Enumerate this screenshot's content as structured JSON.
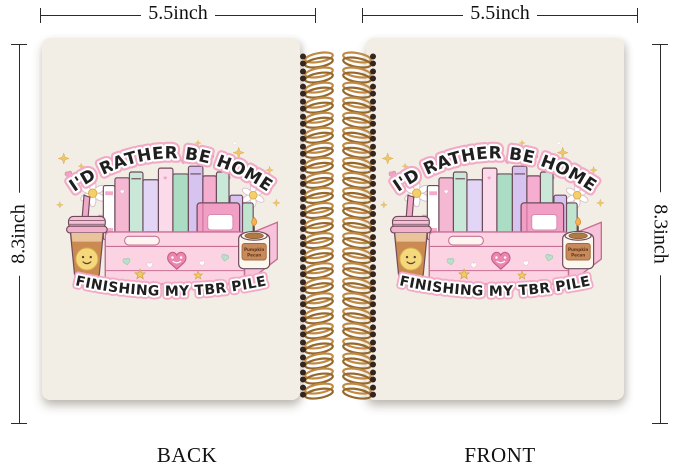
{
  "product_photo": {
    "background": "#ffffff",
    "dimensions": {
      "width_label": "5.5inch",
      "height_label": "8.3inch"
    },
    "views": {
      "back_label": "BACK",
      "front_label": "FRONT"
    },
    "notebook": {
      "cover_color": "#f3eee5",
      "spiral": {
        "wire_color": "#c08a45",
        "hole_color": "#35251c",
        "loop_count": 23
      },
      "artwork": {
        "top_text": "I'D RATHER BE HOME",
        "bottom_text": "FINISHING MY TBR PILE",
        "candle_label": {
          "line1": "Pumpkin",
          "line2": "Pecan"
        },
        "palette": {
          "pink_outline": "#f2aac6",
          "crate_pink": "#fbd3e3",
          "heart_pink": "#f2a3c2",
          "mint": "#badfcb",
          "lavender": "#d7c3ef",
          "coffee_brown": "#cb8a52",
          "smiley_yellow": "#f5d87c",
          "star_yellow": "#f1cb68",
          "lettering_black": "#1f1f1f"
        }
      }
    }
  }
}
